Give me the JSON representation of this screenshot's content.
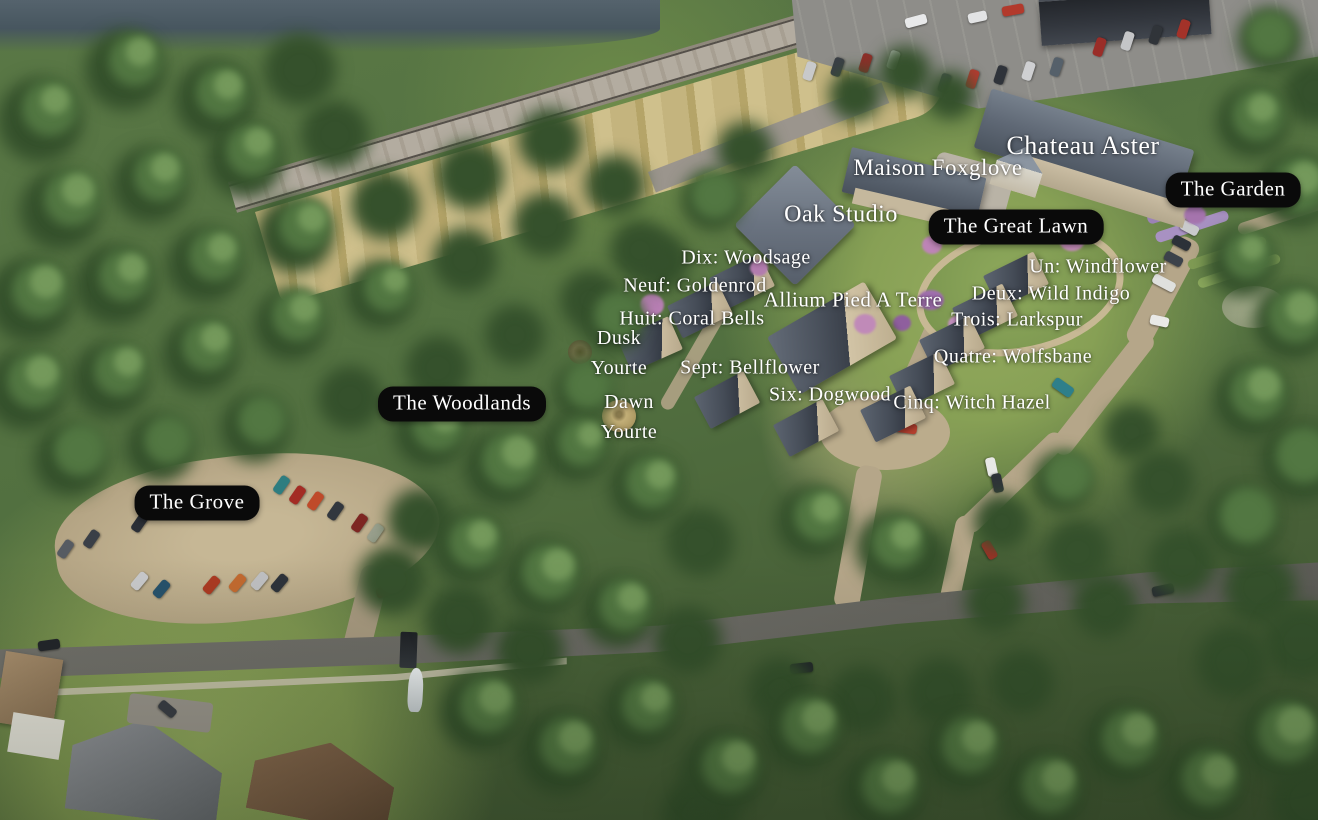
{
  "labels": {
    "chateau_aster": "Chateau Aster",
    "maison_foxglove": "Maison Foxglove",
    "oak_studio": "Oak Studio",
    "the_garden": "The Garden",
    "the_great_lawn": "The Great Lawn",
    "dix_woodsage": "Dix: Woodsage",
    "neuf_goldenrod": "Neuf: Goldenrod",
    "allium_pied_a_terre": "Allium Pied A Terre",
    "un_windflower": "Un: Windflower",
    "deux_wild_indigo": "Deux: Wild Indigo",
    "huit_coral_bells": "Huit: Coral Bells",
    "trois_larkspur": "Trois: Larkspur",
    "quatre_wolfsbane": "Quatre: Wolfsbane",
    "cinq_witch_hazel": "Cinq: Witch Hazel",
    "six_dogwood": "Six: Dogwood",
    "sept_bellflower": "Sept: Bellflower",
    "dusk_yurt_line1": "Dusk",
    "dusk_yurt_line2": "Yourte",
    "dawn_yurt_line1": "Dawn",
    "dawn_yurt_line2": "Yourte",
    "the_woodlands": "The Woodlands",
    "the_grove": "The Grove"
  },
  "colors": {
    "label_text": "#ffffff",
    "area_pill_background": "#0a0a0a",
    "tree_canopy": "#4a6539",
    "meadow_grass": "#c2b177",
    "gravel_path": "#b9ab8d",
    "asphalt_road": "#72716b",
    "slate_roof": "#4d5662",
    "water": "#4e5d68"
  }
}
